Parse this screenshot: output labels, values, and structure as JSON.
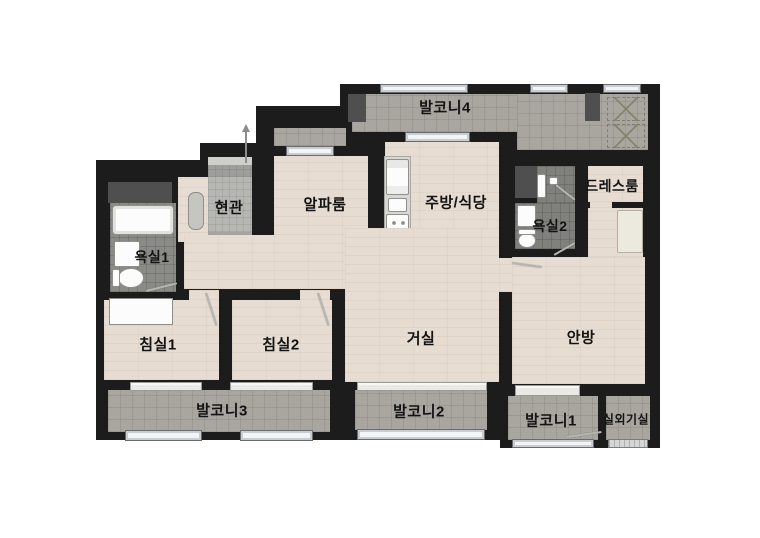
{
  "figure": "apartment-floor-plan",
  "rooms": {
    "balcony4": {
      "label": "발코니4"
    },
    "entrance": {
      "label": "현관"
    },
    "alpha_room": {
      "label": "알파룸"
    },
    "kitchen_dining": {
      "label": "주방/식당"
    },
    "dress_room": {
      "label": "드레스룸"
    },
    "bathroom2": {
      "label": "욕실2"
    },
    "bathroom1": {
      "label": "욕실1"
    },
    "bedroom1": {
      "label": "침실1"
    },
    "bedroom2": {
      "label": "침실2"
    },
    "living_room": {
      "label": "거실"
    },
    "master_bedroom": {
      "label": "안방"
    },
    "balcony3": {
      "label": "발코니3"
    },
    "balcony2": {
      "label": "발코니2"
    },
    "balcony1": {
      "label": "발코니1"
    },
    "ac_unit_room": {
      "label": "실외기실"
    }
  },
  "colors": {
    "wall": "#1c1c1c",
    "wood_floor": "#e6dcd2",
    "balcony_tile": "#a8a69e",
    "bathroom_tile": "#8a8a86",
    "entrance_tile": "#b6b6b2",
    "window": "#f2f4f5",
    "label_text": "#131313",
    "background": "#ffffff"
  }
}
